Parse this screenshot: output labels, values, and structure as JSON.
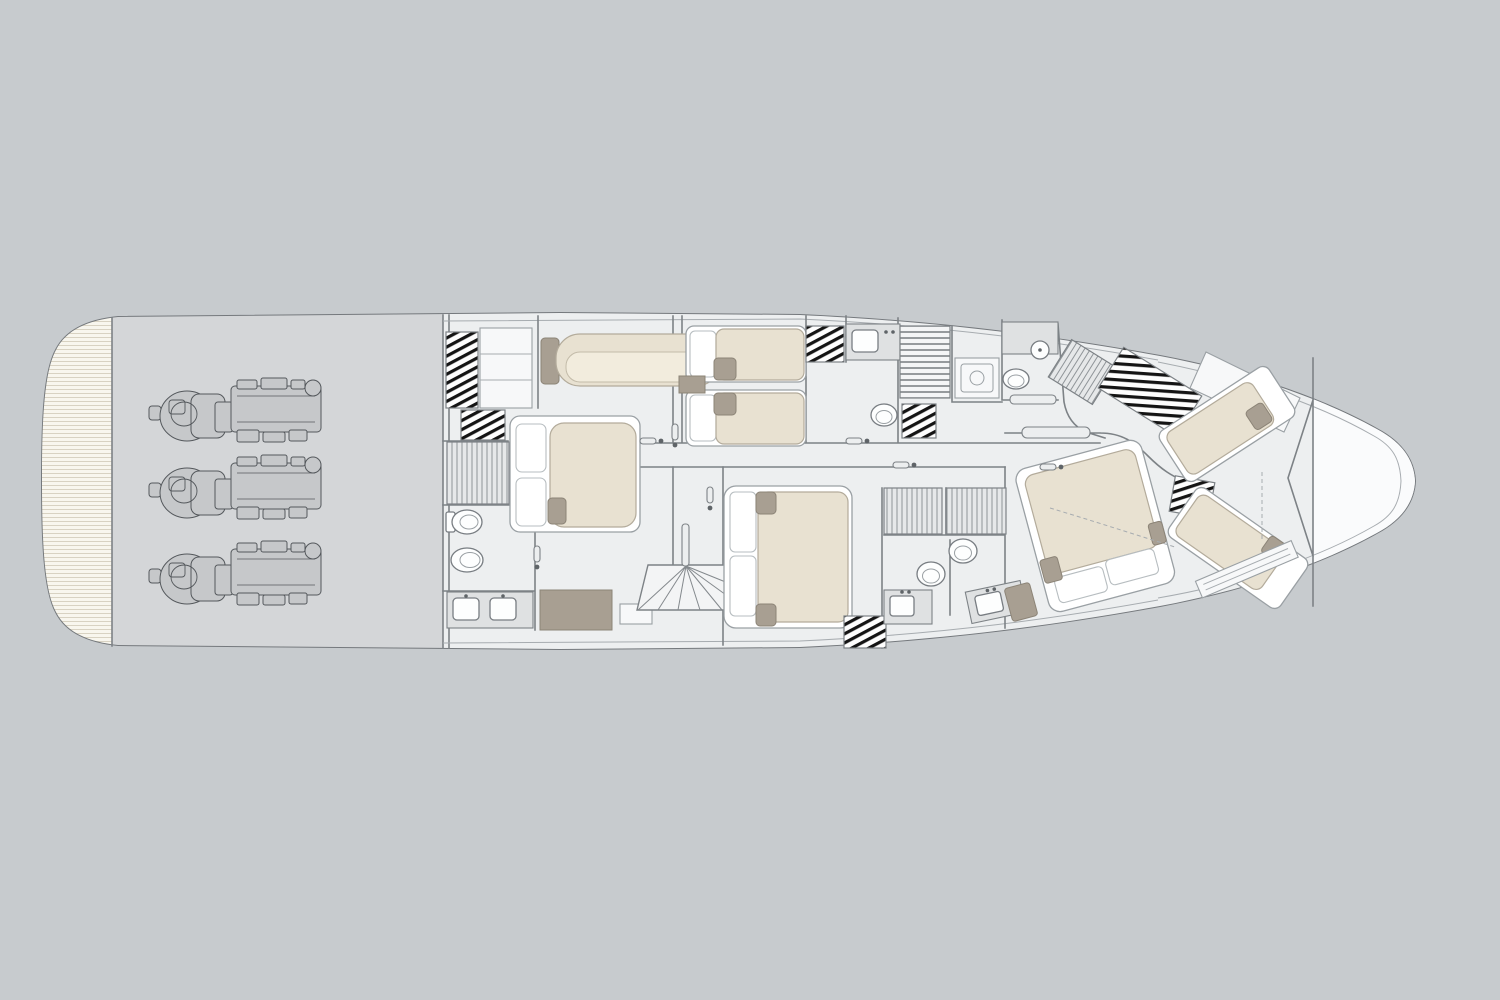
{
  "canvas": {
    "width": 1500,
    "height": 1000
  },
  "scene": {
    "kind": "yacht-floor-plan",
    "deck": "lower-deck",
    "view": "top-down",
    "bow_direction": "right"
  },
  "colors": {
    "background": "#c7cbce",
    "hull_fill": "#ffffff",
    "hull_stroke": "#75797d",
    "inner_line": "#a7acb0",
    "wall": "#7d8286",
    "floor": "#edeff0",
    "bow_floor": "#fafbfc",
    "engine_room_floor": "#d4d6d8",
    "engine_fill": "#c6c8ca",
    "engine_stroke": "#54585c",
    "bed_frame": "#ffffff",
    "bed_stroke": "#9aa0a4",
    "bed_mattress": "#e8e1d1",
    "mattress_stroke": "#b3ab9b",
    "taupe": "#a89f92",
    "counter": "#dfe1e2",
    "fixture": "#fdfefe",
    "teak_light": "#f8f6ee",
    "teak_line": "#d8d2c2",
    "hatch_line": "#141414",
    "stripe_line": "#8f9498",
    "shower_floor": "#e6e8e9",
    "stair_line": "#6e7377"
  },
  "zones": [
    {
      "id": "swim-platform",
      "desc": "teak swim platform at stern (left)"
    },
    {
      "id": "engine-room",
      "desc": "engine room with three inboard engines"
    },
    {
      "id": "master-cabin",
      "desc": "full-beam master cabin: double bed, sofa, wardrobes, walk-in closet"
    },
    {
      "id": "master-bathroom",
      "desc": "ensuite with twin-sink vanity, toilet and bidet"
    },
    {
      "id": "main-staircase",
      "desc": "companionway stairs amidships"
    },
    {
      "id": "twin-cabin",
      "desc": "cabin with two single beds"
    },
    {
      "id": "twin-bathroom",
      "desc": "ensuite with sink and toilet"
    },
    {
      "id": "service-area",
      "desc": "crew stairs, laundry appliance, wardrobe"
    },
    {
      "id": "day-head",
      "desc": "bathroom with round basin, toilet and shower"
    },
    {
      "id": "mid-cabin",
      "desc": "double-bed guest cabin"
    },
    {
      "id": "guest-bathrooms",
      "desc": "two shower rooms with toilets and sink vanities"
    },
    {
      "id": "vip-cabin",
      "desc": "forward double cabin with angled bed"
    },
    {
      "id": "forward-cabin",
      "desc": "two angled single berths in the bow"
    },
    {
      "id": "bow-storage",
      "desc": "forepeak locker beyond collision bulkhead"
    }
  ],
  "counts": {
    "engines": 3,
    "double_beds": 3,
    "single_beds": 4,
    "sofas": 1,
    "toilets": 5,
    "bidets": 1,
    "sinks": 6,
    "shower_floors": 3,
    "staircases": 2,
    "hatched_wardrobes": 7
  }
}
